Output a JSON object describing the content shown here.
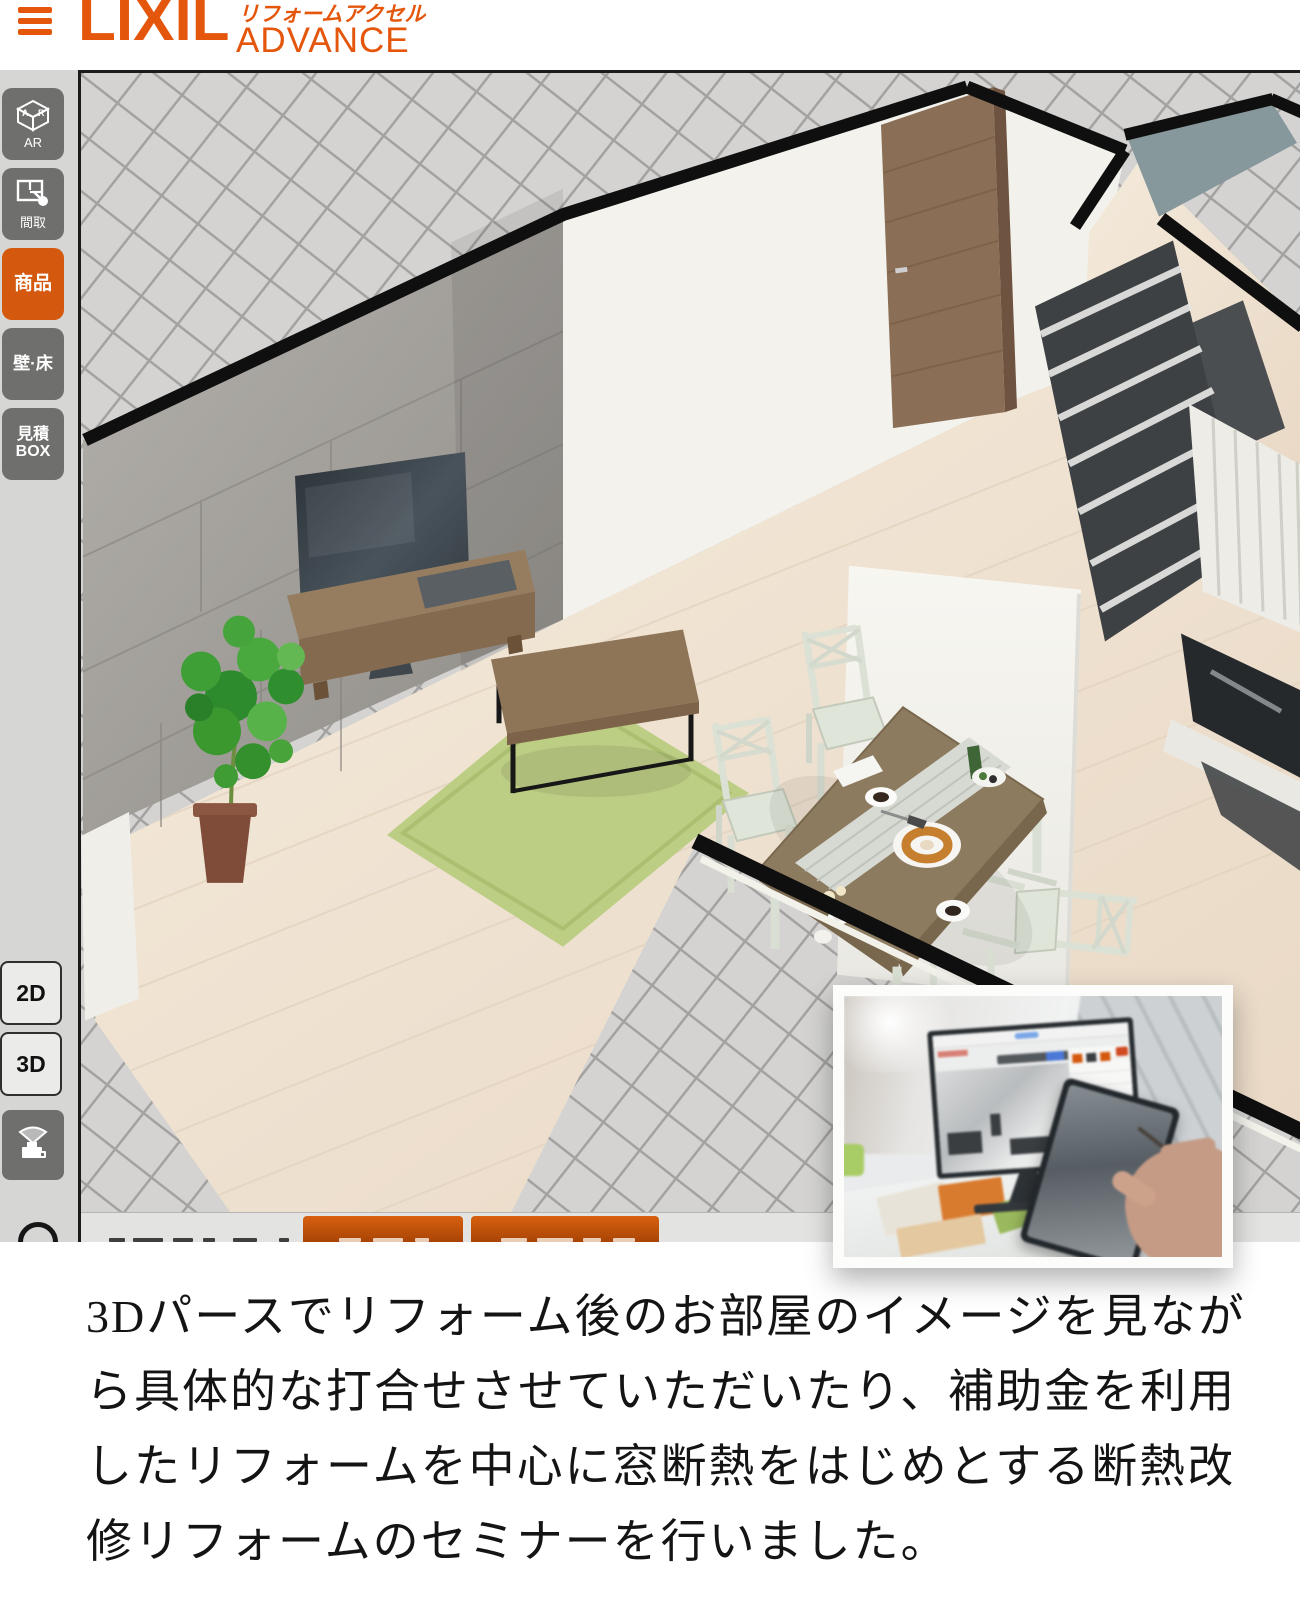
{
  "header": {
    "menu_icon": "hamburger-menu-icon",
    "brand": "LIXIL",
    "brand_sub_line1": "リフォームアクセル",
    "brand_sub_line2": "ADVANCE",
    "brand_color": "#e4560c"
  },
  "sidebar": {
    "active_color": "#d4590e",
    "button_color": "#6f6f6d",
    "tools": [
      {
        "id": "ar",
        "label": "AR",
        "icon": "ar-cube-icon",
        "icon_letter_a": "A",
        "icon_letter_r": "R",
        "active": false
      },
      {
        "id": "madori",
        "label": "間取",
        "icon": "floorplan-cursor-icon",
        "active": false
      },
      {
        "id": "shouhin",
        "label": "商品",
        "active": true
      },
      {
        "id": "kabe-yuka",
        "label": "壁·床",
        "active": false
      },
      {
        "id": "mitsumori-box",
        "label": "見積\nBOX",
        "active": false
      }
    ],
    "view_buttons": [
      {
        "id": "2d",
        "label": "2D"
      },
      {
        "id": "3d",
        "label": "3D"
      }
    ],
    "camera_button_icon": "walkthrough-camera-icon",
    "help_icon": "help-circle-icon"
  },
  "canvas": {
    "scene": "3d-room-perspective-living-dining",
    "objects": [
      "tiled-ground",
      "stone-accent-wall",
      "tv",
      "tv-board",
      "potted-plant",
      "green-rug",
      "coffee-table",
      "dining-table",
      "dining-chairs",
      "wood-door",
      "staircase",
      "kitchen-counter"
    ],
    "bottom_toolbar": {
      "buttons": [
        {
          "id": "orange-button-1"
        },
        {
          "id": "orange-button-2"
        }
      ]
    }
  },
  "description": {
    "text": "3Dパースでリフォーム後のお部屋のイメージを見なが\nら具体的な打合せさせていただいたり、補助金を利用\nしたリフォームを中心に窓断熱をはじめとする断熱改\n修リフォームのセミナーを行いました。"
  }
}
